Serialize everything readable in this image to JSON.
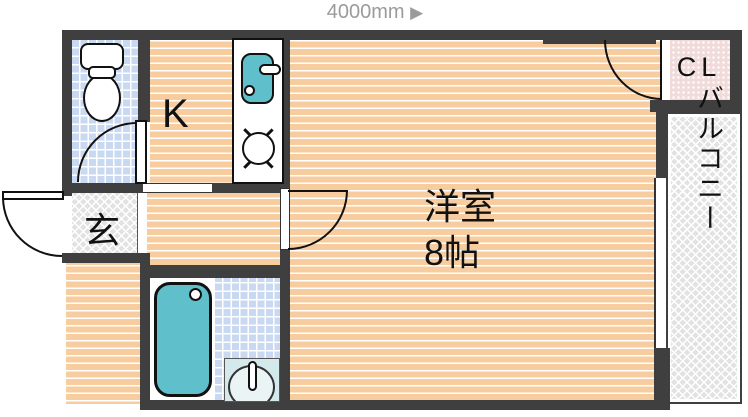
{
  "scale_label": {
    "text": "4000mm",
    "arrow": "▶"
  },
  "rooms": {
    "kitchen": {
      "label": "K"
    },
    "western_room": {
      "label": "洋室",
      "size": "8帖"
    },
    "entrance": {
      "label": "玄"
    },
    "closet": {
      "label": "CL"
    },
    "balcony": {
      "label": "バルコニー"
    }
  },
  "icons": {
    "toilet": "toilet-icon",
    "sink": "kitchen-sink-icon",
    "stove": "stove-burner-icon",
    "bathtub": "bathtub-icon",
    "washbasin": "washbasin-icon"
  },
  "colors": {
    "wall": "#3f3f3f",
    "line": "#111111",
    "floor": "#f7cda0",
    "tile": "#c9d9f1",
    "hatch": "#e2e2e2",
    "closet": "#f1dada",
    "teal": "#5fc0cb",
    "basin": "#d4e9ec",
    "labelgray": "#9b9b9b"
  }
}
